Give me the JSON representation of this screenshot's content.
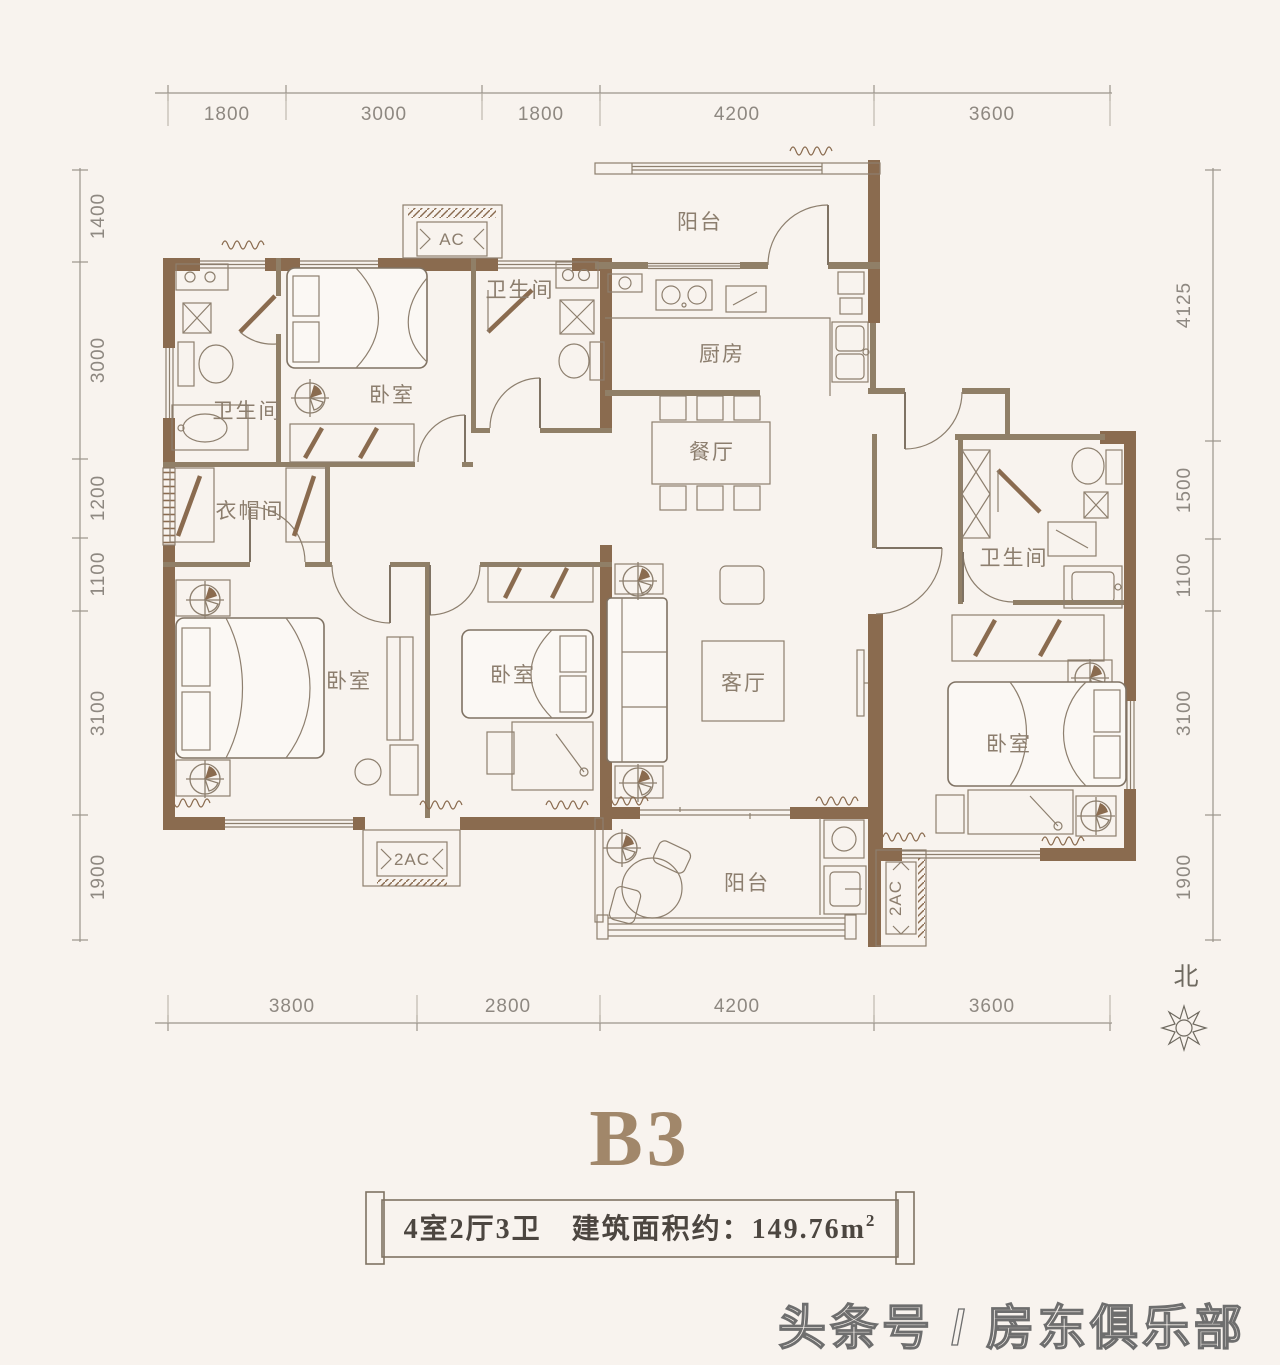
{
  "title": {
    "name": "B3"
  },
  "banner": {
    "spec": "4室2厅3卫　建筑面积约：149.76m",
    "sup": "2"
  },
  "watermark": {
    "text": "头条号 / 房东俱乐部"
  },
  "north": {
    "label": "北"
  },
  "ac_units": {
    "top": "AC",
    "bottom_left": "2AC",
    "bottom_right": "2AC"
  },
  "rooms": {
    "balcony_top": "阳台",
    "bath_mid": "卫生间",
    "kitchen": "厨房",
    "bedroom_tl": "卧室",
    "bath_left": "卫生间",
    "dining": "餐厅",
    "cloakroom": "衣帽间",
    "bath_right": "卫生间",
    "bedroom_bl": "卧室",
    "bedroom_bm": "卧室",
    "living": "客厅",
    "bedroom_r": "卧室",
    "balcony_bottom": "阳台"
  },
  "dimensions": {
    "top": [
      "1800",
      "3000",
      "1800",
      "4200",
      "3600"
    ],
    "bottom": [
      "3800",
      "2800",
      "4200",
      "3600"
    ],
    "left": [
      "1400",
      "3000",
      "1200",
      "1100",
      "3100",
      "1900"
    ],
    "right": [
      "4125",
      "1500",
      "1100",
      "3100",
      "1900"
    ]
  },
  "colors": {
    "wall": "#8a6b4f",
    "line": "#7f7263",
    "furniture": "#8d7f6e",
    "room_text": "#8c7e6e",
    "dim_text": "#8e8881",
    "title": "#a1876a",
    "banner_text": "#4c4640",
    "watermark": "#6e6e6e",
    "background": "#f8f3ee"
  }
}
